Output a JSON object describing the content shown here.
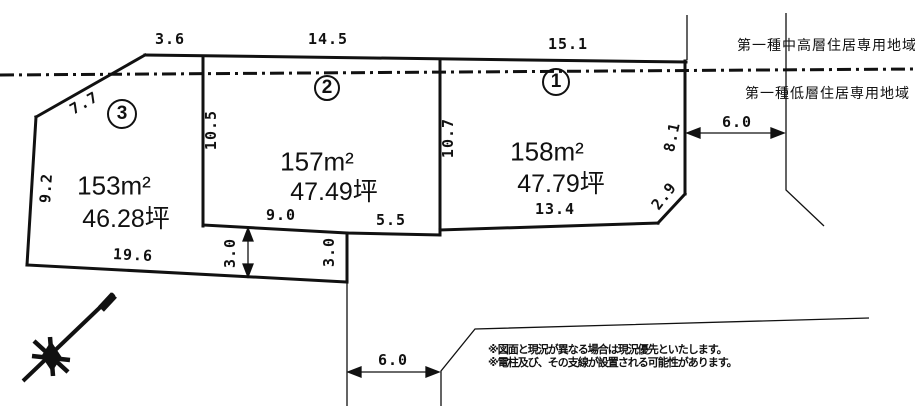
{
  "colors": {
    "ink": "#1a1a1a",
    "background": "#ffffff"
  },
  "zoning": {
    "upper": "第一種中高層住居専用地域",
    "lower": "第一種低層住居専用地域"
  },
  "plots": [
    {
      "number": "1",
      "area_m2": "158m²",
      "area_tsubo": "47.79坪",
      "dim_top": "15.1",
      "dim_left": "10.7",
      "dim_right": "8.1",
      "dim_bottom": "13.4",
      "dim_corner": "2.9"
    },
    {
      "number": "2",
      "area_m2": "157m²",
      "area_tsubo": "47.49坪",
      "dim_top": "14.5",
      "dim_left": "10.5",
      "dim_bottom_left": "9.0",
      "dim_bottom_right": "5.5"
    },
    {
      "number": "3",
      "area_m2": "153m²",
      "area_tsubo": "46.28坪",
      "dim_top": "3.6",
      "dim_upper_left": "7.7",
      "dim_left": "9.2",
      "dim_bottom": "19.6"
    }
  ],
  "setback_strip": {
    "dim_left": "3.0",
    "dim_right": "3.0"
  },
  "road_dims": {
    "upper_right": "6.0",
    "bottom": "6.0"
  },
  "notes": {
    "line1": "※図面と現況が異なる場合は現況優先といたします。",
    "line2": "※電柱及び、その支線が設置される可能性があります。"
  }
}
